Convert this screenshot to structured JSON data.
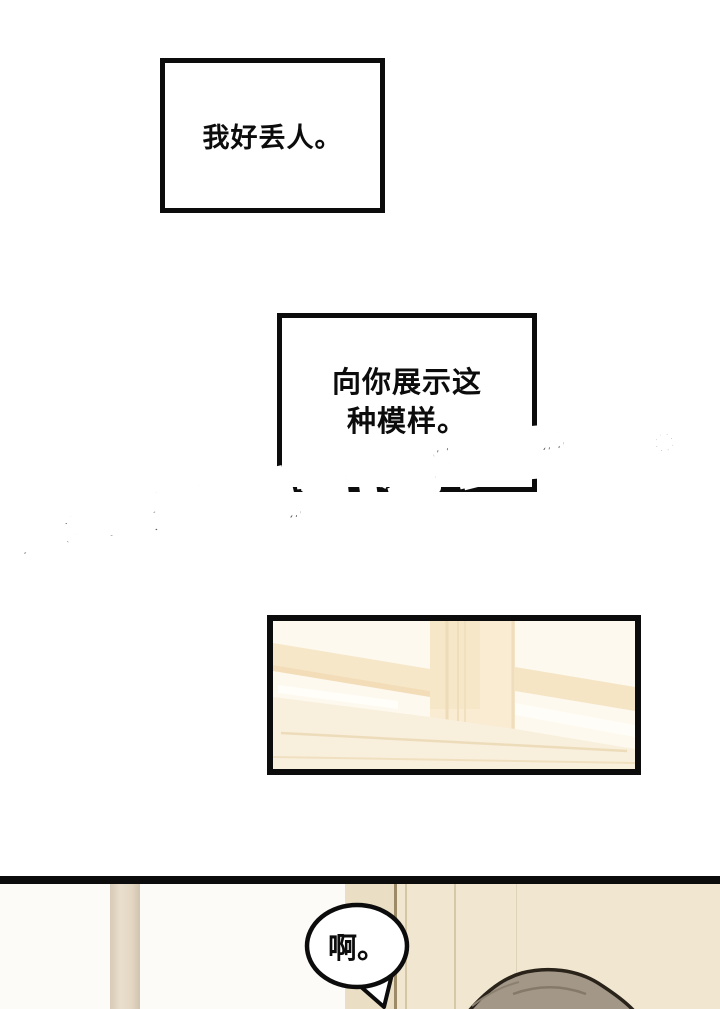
{
  "caption_box_1": {
    "text": "我好丢人。"
  },
  "caption_box_2": {
    "lines": [
      "向你展示这",
      "种模样。"
    ]
  },
  "watermark": {
    "text": "更多免费漫画,请下载“画涯”APP。"
  },
  "speech_bubble": {
    "text": "啊。"
  },
  "colors": {
    "ink": "#0c0c0c",
    "page_bg": "#ffffff",
    "watermark_outline": "#616161",
    "panel_cream": "#fdf9ee",
    "panel_tan": "#f7e7c9",
    "wall_beige": "#f1e7d1",
    "door_jamb": "#eadec5",
    "hair": "#a39888",
    "hair_outline": "#2a231a"
  }
}
